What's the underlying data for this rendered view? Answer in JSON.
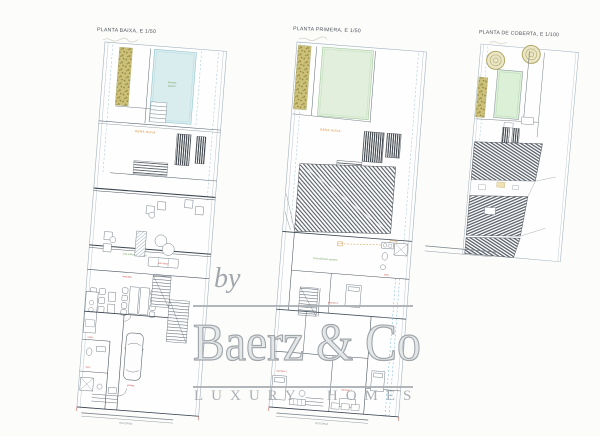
{
  "sheet": {
    "background": "#fcfcfb"
  },
  "plans": [
    {
      "id": "planta-baixa",
      "title": "PLANTA BAIXA, E 1/50",
      "labels": {
        "obra_nova": "OBRA NOVA",
        "pool_note_1": "terrassa",
        "pool_note_2": "piscina",
        "line_note": "línia edificació existent",
        "sala": "sala d'estar",
        "menjador": "menjador",
        "cuina": "cuina",
        "bany": "bany",
        "garatge": "garatge",
        "reforma": "REFORMA"
      }
    },
    {
      "id": "planta-primera",
      "title": "PLANTA PRIMERA, E 1/50",
      "labels": {
        "obra_nova": "OBRA NOVA",
        "line_note": "línia edificació existent",
        "dorm1": "dormitori 1",
        "dorm2": "dormitori 2",
        "dorm3": "dormitori 3",
        "bany": "bany",
        "reforma": "REFORMA"
      }
    },
    {
      "id": "planta-coberta",
      "title": "PLANTA DE COBERTA, E 1/100"
    }
  ],
  "watermark": {
    "by": "by",
    "brand": "Baerz & Co",
    "tagline": "LUXURY HOMES",
    "color": "#a6abb0"
  },
  "palette": {
    "pool": "#d9edef",
    "lawn": "#e2efdd",
    "garden": "#cdc179",
    "hatch_dark": "#383f46",
    "roof_hatch": "#60666e",
    "line": "#4d5964",
    "boundary": "#a3b2bd",
    "note_orange": "#d28a2e",
    "note_red": "#c2483e",
    "note_green": "#68a356",
    "watermark_gray": "#a6abb0"
  }
}
